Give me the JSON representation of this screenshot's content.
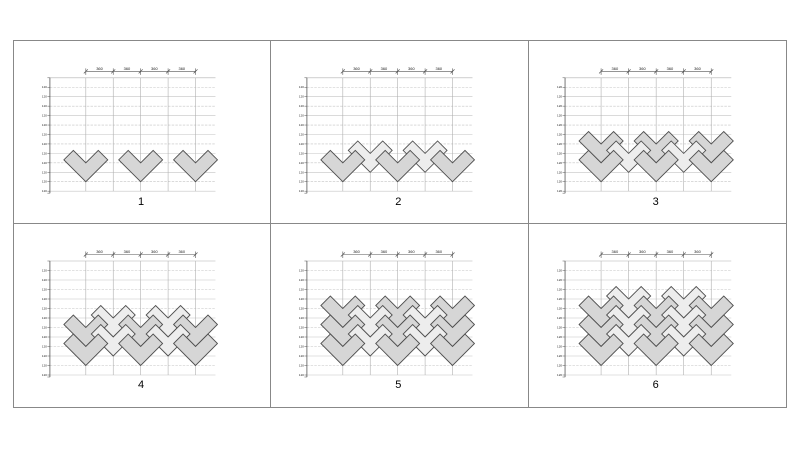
{
  "frame": {
    "border_color": "#888888"
  },
  "diagram_style": {
    "chevron_dark_fill": "#d6d6d6",
    "chevron_light_fill": "#ededed",
    "chevron_stroke": "#4f4f4f",
    "grid_line_color": "#c4c4c4",
    "column_line_color": "#b0b0b0",
    "axis_color": "#555555",
    "label_color": "#222222"
  },
  "panels": [
    {
      "label": "1",
      "dim_labels": [
        "360",
        "360",
        "360",
        "360"
      ],
      "axis_tick_label": "120",
      "chevrons": [
        {
          "col": 0,
          "course": 0,
          "shade": "dark"
        },
        {
          "col": 2,
          "course": 0,
          "shade": "dark"
        },
        {
          "col": 4,
          "course": 0,
          "shade": "dark"
        }
      ]
    },
    {
      "label": "2",
      "dim_labels": [
        "360",
        "360",
        "360",
        "360"
      ],
      "axis_tick_label": "120",
      "chevrons": [
        {
          "col": 0,
          "course": 0,
          "shade": "dark"
        },
        {
          "col": 1,
          "course": 0,
          "shade": "light"
        },
        {
          "col": 2,
          "course": 0,
          "shade": "dark"
        },
        {
          "col": 3,
          "course": 0,
          "shade": "light"
        },
        {
          "col": 4,
          "course": 0,
          "shade": "dark"
        }
      ]
    },
    {
      "label": "3",
      "dim_labels": [
        "360",
        "360",
        "360",
        "360"
      ],
      "axis_tick_label": "120",
      "chevrons": [
        {
          "col": 0,
          "course": 0,
          "shade": "dark"
        },
        {
          "col": 0,
          "course": 1,
          "shade": "dark"
        },
        {
          "col": 1,
          "course": 0,
          "shade": "light"
        },
        {
          "col": 2,
          "course": 0,
          "shade": "dark"
        },
        {
          "col": 2,
          "course": 1,
          "shade": "dark"
        },
        {
          "col": 3,
          "course": 0,
          "shade": "light"
        },
        {
          "col": 4,
          "course": 0,
          "shade": "dark"
        },
        {
          "col": 4,
          "course": 1,
          "shade": "dark"
        }
      ]
    },
    {
      "label": "4",
      "dim_labels": [
        "360",
        "360",
        "360",
        "360"
      ],
      "axis_tick_label": "120",
      "chevrons": [
        {
          "col": 0,
          "course": 0,
          "shade": "dark"
        },
        {
          "col": 0,
          "course": 1,
          "shade": "dark"
        },
        {
          "col": 1,
          "course": 0,
          "shade": "light"
        },
        {
          "col": 1,
          "course": 1,
          "shade": "light"
        },
        {
          "col": 2,
          "course": 0,
          "shade": "dark"
        },
        {
          "col": 2,
          "course": 1,
          "shade": "dark"
        },
        {
          "col": 3,
          "course": 0,
          "shade": "light"
        },
        {
          "col": 3,
          "course": 1,
          "shade": "light"
        },
        {
          "col": 4,
          "course": 0,
          "shade": "dark"
        },
        {
          "col": 4,
          "course": 1,
          "shade": "dark"
        }
      ]
    },
    {
      "label": "5",
      "dim_labels": [
        "360",
        "360",
        "360",
        "360"
      ],
      "axis_tick_label": "120",
      "chevrons": [
        {
          "col": 0,
          "course": 0,
          "shade": "dark"
        },
        {
          "col": 0,
          "course": 1,
          "shade": "dark"
        },
        {
          "col": 0,
          "course": 2,
          "shade": "dark"
        },
        {
          "col": 1,
          "course": 0,
          "shade": "light"
        },
        {
          "col": 1,
          "course": 1,
          "shade": "light"
        },
        {
          "col": 2,
          "course": 0,
          "shade": "dark"
        },
        {
          "col": 2,
          "course": 1,
          "shade": "dark"
        },
        {
          "col": 2,
          "course": 2,
          "shade": "dark"
        },
        {
          "col": 3,
          "course": 0,
          "shade": "light"
        },
        {
          "col": 3,
          "course": 1,
          "shade": "light"
        },
        {
          "col": 4,
          "course": 0,
          "shade": "dark"
        },
        {
          "col": 4,
          "course": 1,
          "shade": "dark"
        },
        {
          "col": 4,
          "course": 2,
          "shade": "dark"
        }
      ]
    },
    {
      "label": "6",
      "dim_labels": [
        "360",
        "360",
        "360",
        "360"
      ],
      "axis_tick_label": "120",
      "chevrons": [
        {
          "col": 0,
          "course": 0,
          "shade": "dark"
        },
        {
          "col": 0,
          "course": 1,
          "shade": "dark"
        },
        {
          "col": 0,
          "course": 2,
          "shade": "dark"
        },
        {
          "col": 1,
          "course": 0,
          "shade": "light"
        },
        {
          "col": 1,
          "course": 1,
          "shade": "light"
        },
        {
          "col": 1,
          "course": 2,
          "shade": "light"
        },
        {
          "col": 2,
          "course": 0,
          "shade": "dark"
        },
        {
          "col": 2,
          "course": 1,
          "shade": "dark"
        },
        {
          "col": 2,
          "course": 2,
          "shade": "dark"
        },
        {
          "col": 3,
          "course": 0,
          "shade": "light"
        },
        {
          "col": 3,
          "course": 1,
          "shade": "light"
        },
        {
          "col": 3,
          "course": 2,
          "shade": "light"
        },
        {
          "col": 4,
          "course": 0,
          "shade": "dark"
        },
        {
          "col": 4,
          "course": 1,
          "shade": "dark"
        },
        {
          "col": 4,
          "course": 2,
          "shade": "dark"
        }
      ]
    }
  ]
}
